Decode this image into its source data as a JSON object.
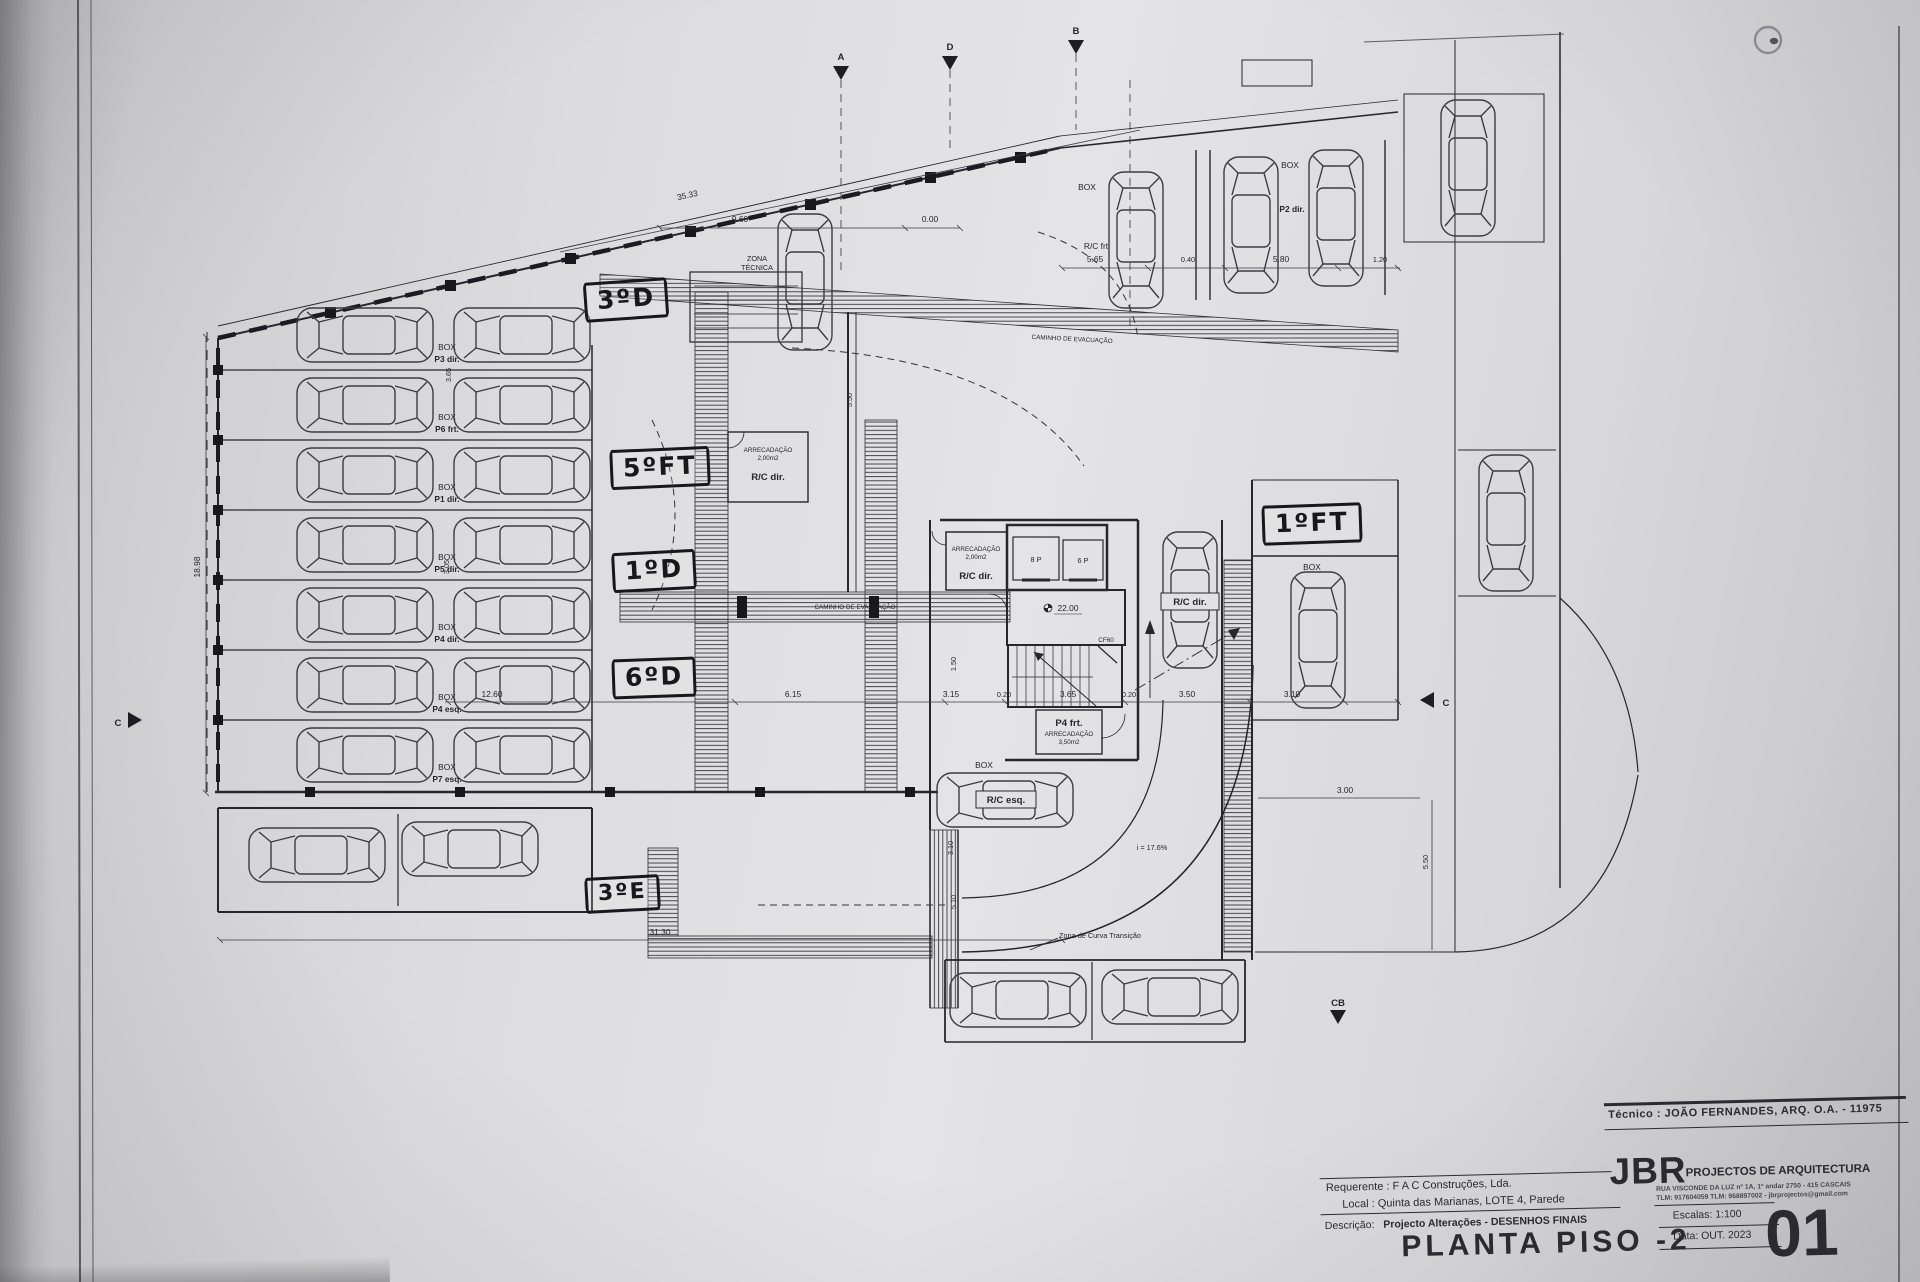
{
  "titleblock": {
    "tecnico": "Técnico : JOÃO FERNANDES, ARQ.   O.A. - 11975",
    "firm_name": "JBR",
    "firm_desc": "PROJECTOS DE ARQUITECTURA",
    "firm_addr1": "RUA VISCONDE DA LUZ nº 1A, 1º andar  2750 - 415  CASCAIS",
    "firm_addr2": "TLM: 917604059  TLM: 968897002 - jbrprojectos@gmail.com",
    "requerente": "Requerente : F A C  Construções, Lda.",
    "local": "Local : Quinta das Marianas, LOTE 4, Parede",
    "descricao_label": "Descrição:",
    "descricao_value": "Projecto Alterações - DESENHOS FINAIS",
    "sheet_title": "PLANTA PISO -2",
    "escala": "Escalas:  1:100",
    "data": "Data: OUT.  2023",
    "sheet_number": "01"
  },
  "handwritten": {
    "h3d": "3ºD",
    "h5ft": "5ºFT",
    "h1d": "1ºD",
    "h6d": "6ºD",
    "h3e": "3ºE",
    "h1ft": "1ºFT"
  },
  "labels": {
    "box": "BOX",
    "zona_1": "ZONA",
    "zona_2": "TÉCNICA",
    "caminho": "CAMINHO DE EVACUAÇÃO",
    "stalls": [
      "P3 dir.",
      "P6 frt.",
      "P1 dir.",
      "P5 dir.",
      "P4 dir.",
      "P4 esq.",
      "P7 esq."
    ],
    "rc_frt": "R/C frt",
    "p2_dir": "P2 dir.",
    "rc_dir": "R/C dir.",
    "rc_esq": "R/C esq.",
    "p4_frt": "P4 frt.",
    "arrecadacao": "ARRECADAÇÃO",
    "area_2": "2,00m2",
    "area_35": "3,50m2",
    "lift_8": "8 P",
    "lift_6": "6 P",
    "level": "22.00",
    "cf60": "CF60",
    "slope": "i = 17.6%",
    "curva": "Zona de Curva Transição"
  },
  "dims": {
    "d3533": "35.33",
    "d960": "9.60",
    "d000": "0.00",
    "d565": "5.65",
    "d040": "0.40",
    "d580": "5.80",
    "d120": "1.20",
    "d1260": "12.60",
    "d615": "6.15",
    "d315": "3.15",
    "d020a": "0.20",
    "d365": "3.65",
    "d020b": "0.20",
    "d350": "3.50",
    "d310": "3.10",
    "d300": "3.00",
    "d550": "5.50",
    "d3130": "31.30",
    "d1898": "18.98",
    "d365v": "3.65",
    "d305v": "3.05",
    "d310v": "3.10",
    "d510v": "5.10",
    "d150": "1.50",
    "d550b": "5.50"
  },
  "markers": {
    "a": "A",
    "b": "B",
    "c": "C",
    "d": "D",
    "cb": "CB"
  }
}
